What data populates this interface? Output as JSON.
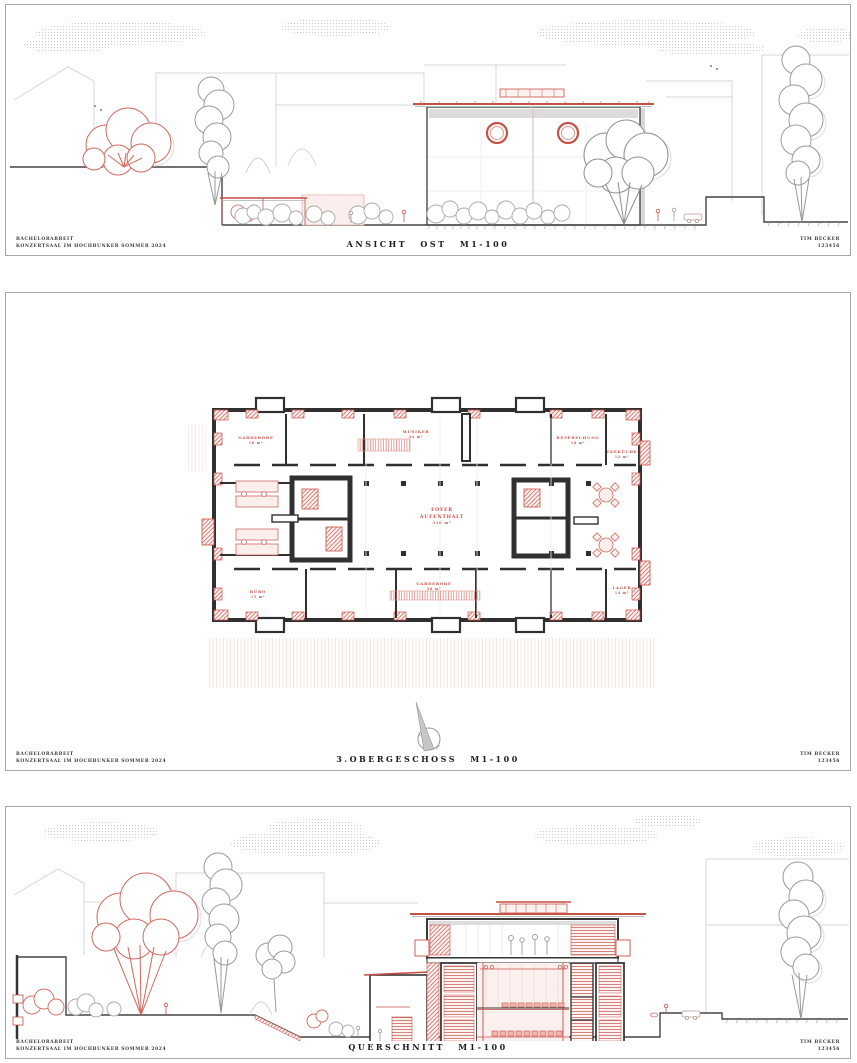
{
  "panels": [
    {
      "title": "ANSICHT OST M1-100"
    },
    {
      "title": "3.OBERGESCHOSS M1-100"
    },
    {
      "title": "QUERSCHNITT M1-100"
    }
  ],
  "titleblock": {
    "project_line1": "BACHELORARBEIT",
    "project_line2": "KONZERTSAAL IM HOCHBUNKER SOMMER 2024",
    "author_line1": "TIM BECKER",
    "author_line2": "123456"
  },
  "plan_labels": {
    "center": [
      "FOYER",
      "AUFENTHALT",
      "310 m²"
    ],
    "rooms": [
      {
        "name": "GARDEROBE",
        "area": "16 m²"
      },
      {
        "name": "MUSIKER",
        "area": "24 m²"
      },
      {
        "name": "BESPRECHUNG",
        "area": "18 m²"
      },
      {
        "name": "TEEKÜCHE",
        "area": "12 m²"
      },
      {
        "name": "LAGER",
        "area": "14 m²"
      },
      {
        "name": "GARDEROBE",
        "area": "28 m²"
      },
      {
        "name": "BÜRO",
        "area": "15 m²"
      }
    ]
  },
  "colors": {
    "accent_red": "#c65147",
    "tree_red": "#d0695e",
    "pink_fill": "#fbeeec",
    "line_gray": "#c9c9c9",
    "dark": "#2f2f2f"
  }
}
